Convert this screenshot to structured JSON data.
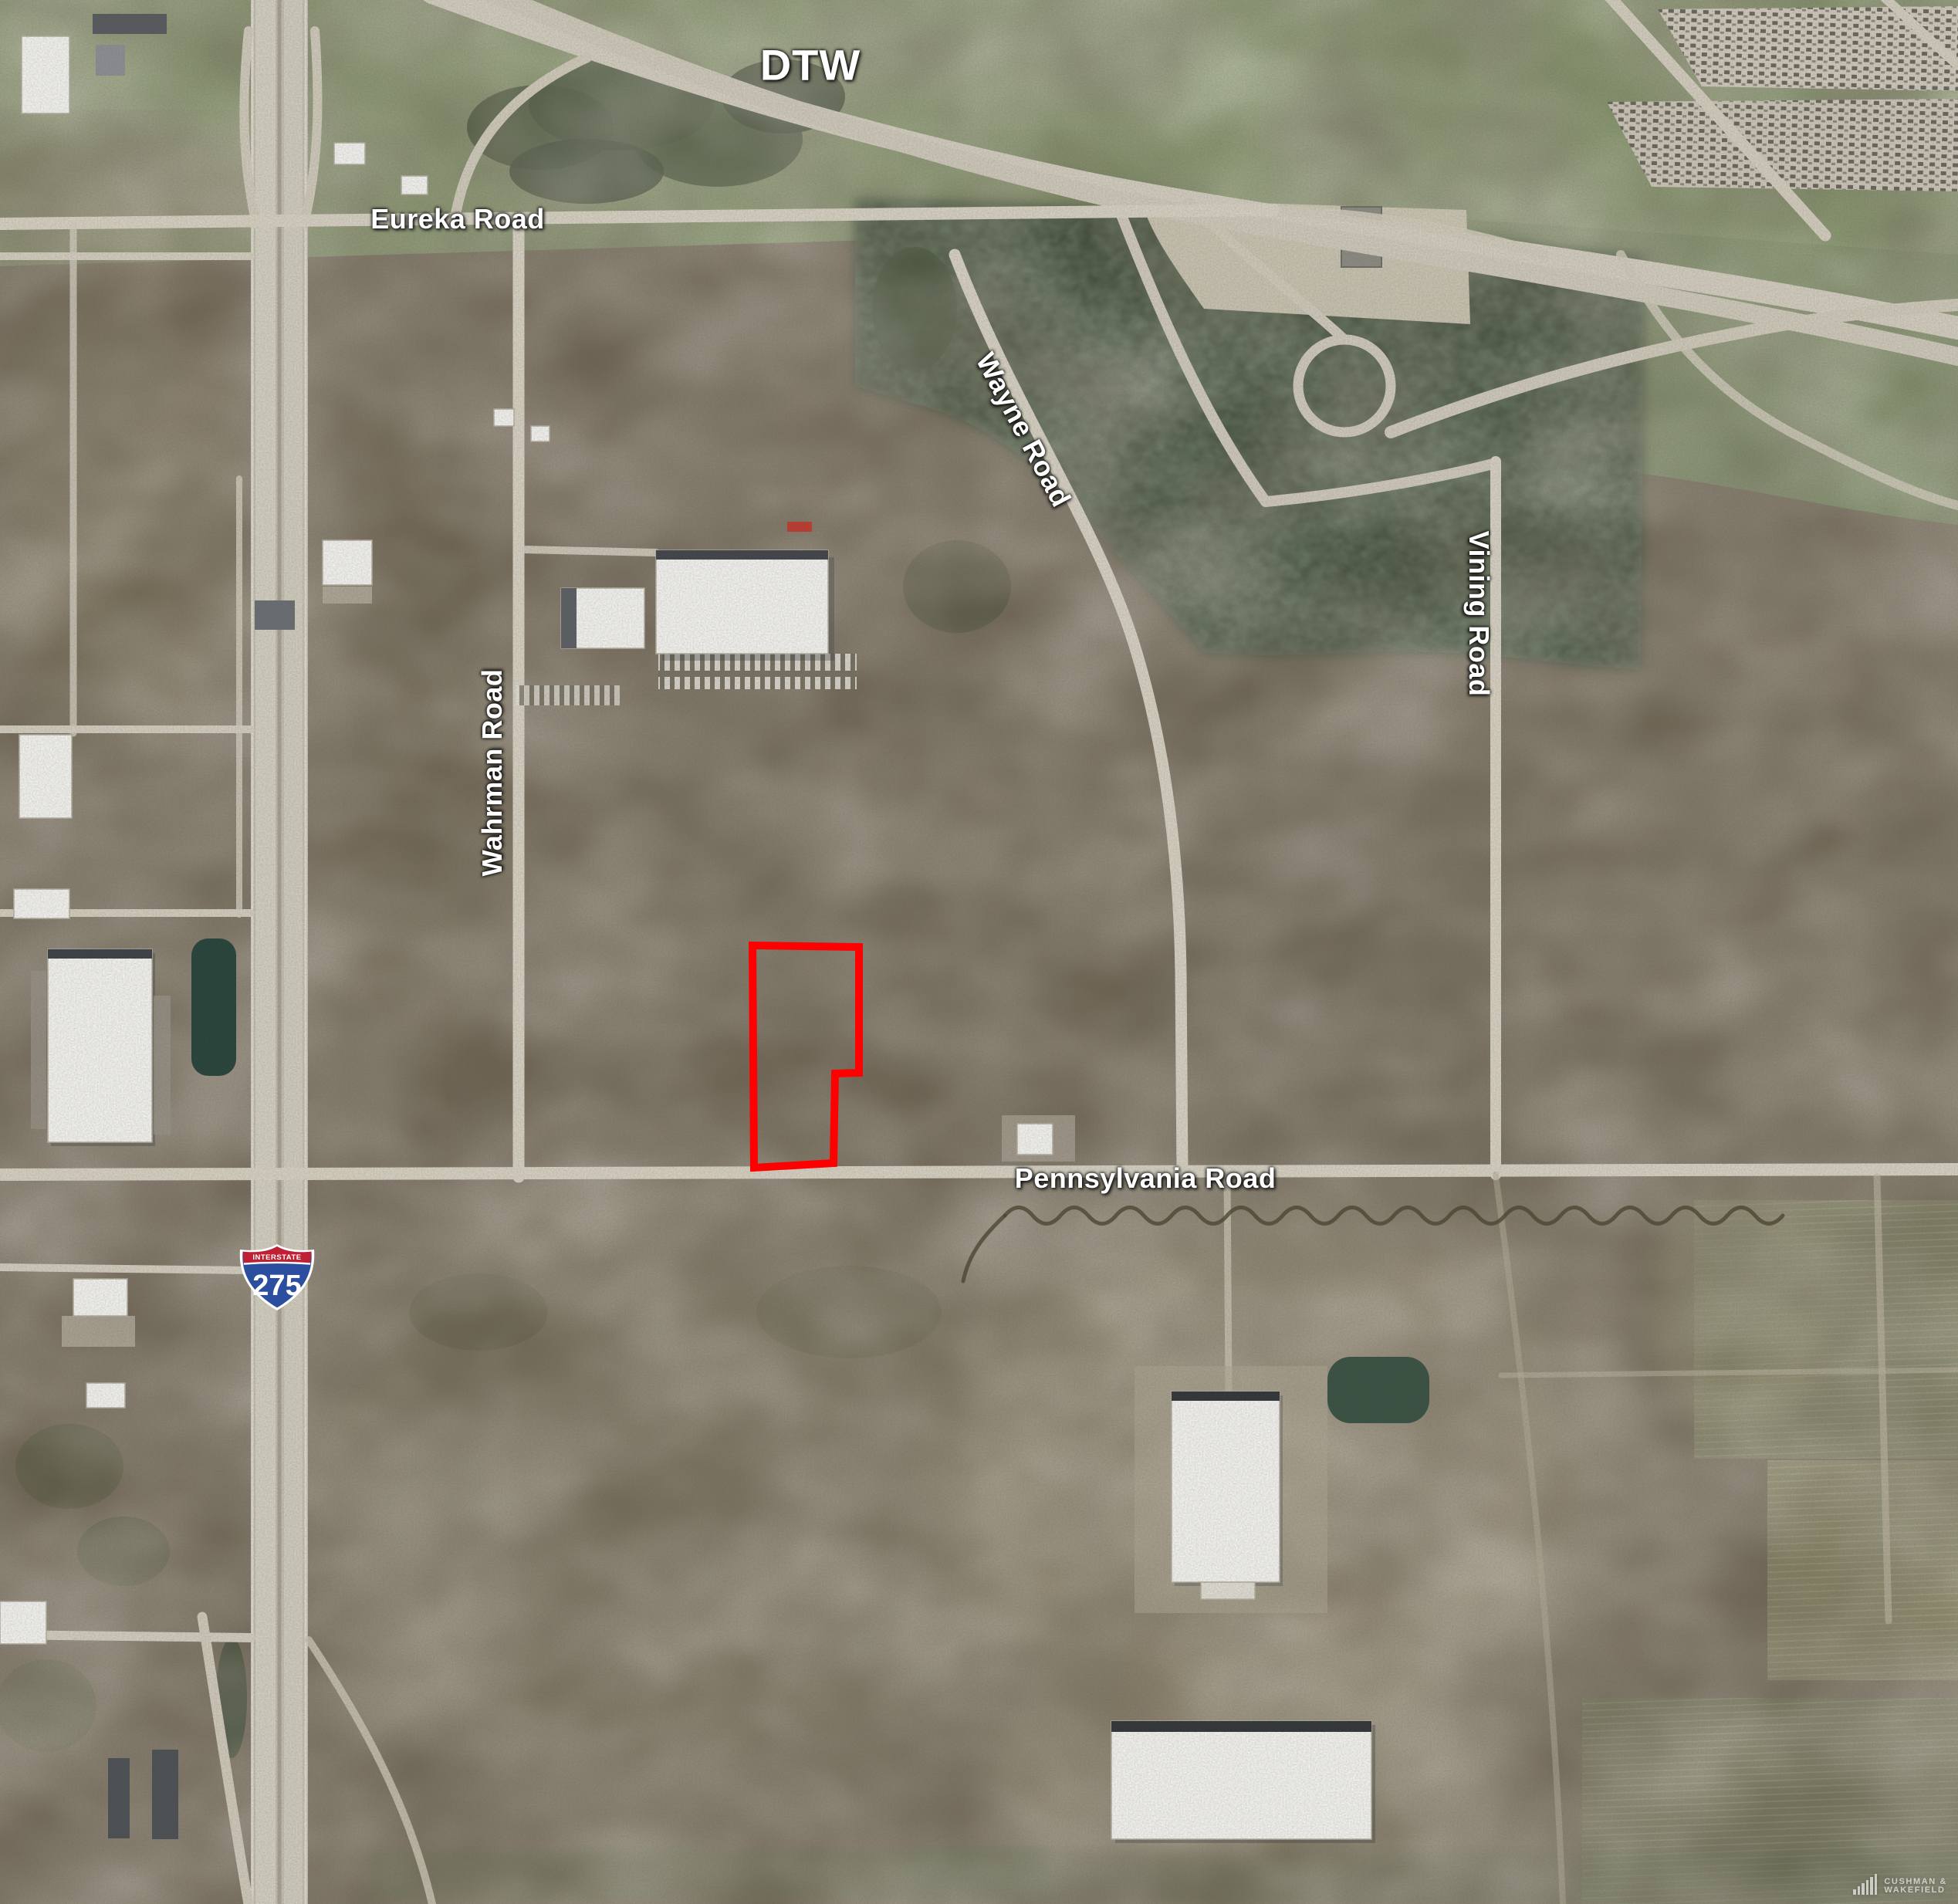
{
  "map": {
    "airport_label": "DTW",
    "road_labels": {
      "eureka": "Eureka Road",
      "wayne": "Wayne Road",
      "vining": "Vining Road",
      "wahrman": "Wahrman Road",
      "pennsylvania": "Pennsylvania Road"
    },
    "interstate_shield": {
      "header": "INTERSTATE",
      "number": "275"
    },
    "parcel_outline_color": "#ff0000",
    "watermark": {
      "line1": "CUSHMAN &",
      "line2": "WAKEFIELD"
    }
  }
}
